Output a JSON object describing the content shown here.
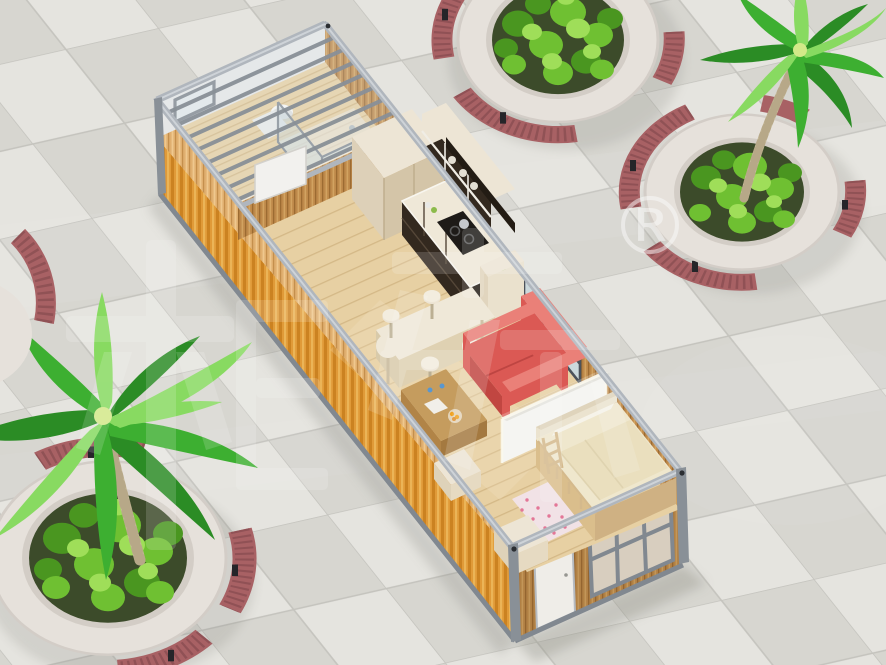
{
  "watermark": {
    "characters": "柜族",
    "registered_symbol": "®"
  },
  "palette": {
    "tile_base": "#E2E1DC",
    "tile_light": "#EAE9E4",
    "tile_dark": "#DCDBD5",
    "tile_line": "#C9C8C2",
    "orange": "#F4A83E",
    "orange_dark": "#DE8E25",
    "orange_light": "#FFC45F",
    "frame": "#B4BAC1",
    "frame_dark": "#848B93",
    "post": "#8C939B",
    "slat": "#C28C4C",
    "slat_dark": "#A06E34",
    "slat_light": "#D7A763",
    "slat_sun": "#E5B372",
    "slat_sun_dark": "#C8924F",
    "slat_sun_light": "#F4CC91",
    "floor_wood": "#ECD5A7",
    "floor_line": "#D9BC8A",
    "white_wall": "#F1F2F0",
    "glass": "#CBDCE3",
    "glass_frame": "#4E545C",
    "cab_dark": "#352A20",
    "cab_cream": "#F2EADA",
    "counter": "#F4EDDD",
    "sofa": "#E05B56",
    "sofa_dark": "#C54843",
    "sofa_light": "#EF837B",
    "table_wood": "#C9A060",
    "table_wood_dark": "#B58749",
    "bed_cream": "#F4ECD2",
    "bed_frame": "#DFC28F",
    "pink_area": "#F6E7EB",
    "pink": "#E8799B",
    "bench": "#AC6367",
    "bench_dark": "#8D5054",
    "bench_leg": "#26262A",
    "stone": "#EBE6E0",
    "stone_shade": "#D8D2CA",
    "soil": "#3E4D2B",
    "shrub": "#72C433",
    "shrub_light": "#A3E35B",
    "shrub_dark": "#4C9A21",
    "palm": "#3FB332",
    "palm_light": "#8BDF63",
    "palm_dark": "#2C8F26",
    "trunk": "#C9BC9B",
    "trunk_dark": "#AE9F7D",
    "door_white": "#F4F2ED",
    "watermark_white": "#FFFFFF",
    "shadow": "#8F8F87"
  }
}
